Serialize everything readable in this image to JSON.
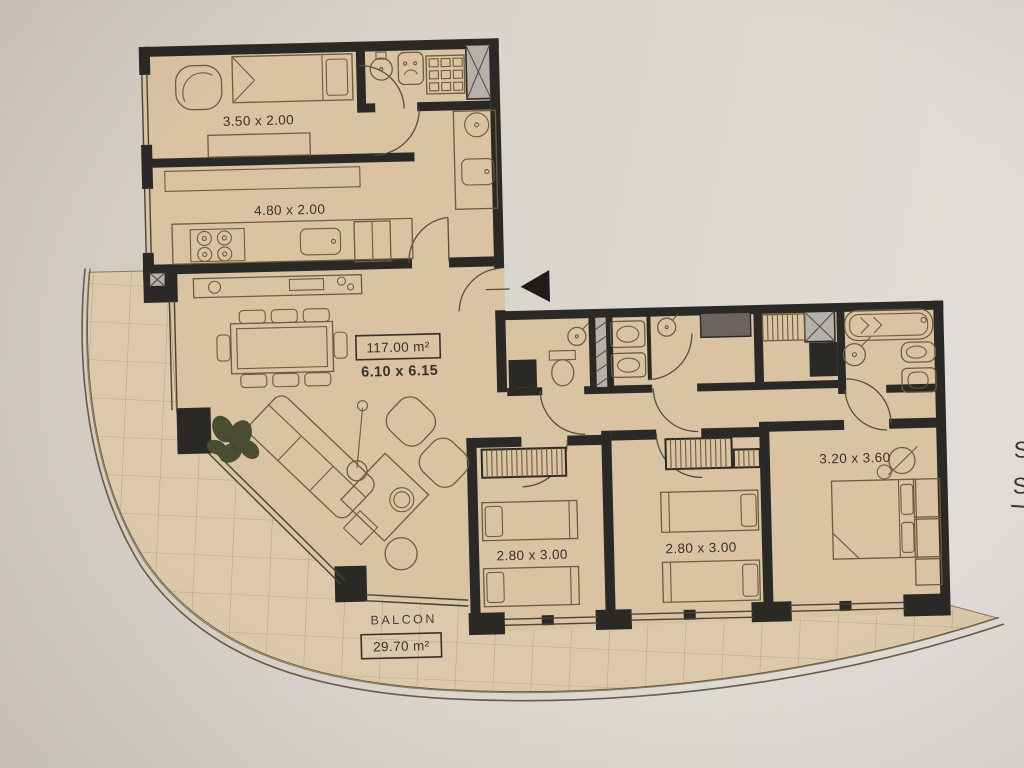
{
  "plan": {
    "labels": {
      "maid_room": "3.50 x 2.00",
      "kitchen": "4.80 x 2.00",
      "living_area": "117.00 m²",
      "living_dims": "6.10 x 6.15",
      "bedroom_a": "2.80 x 3.00",
      "bedroom_b": "2.80 x 3.00",
      "master_bedroom": "3.20 x 3.60",
      "balcony_name": "BALCON",
      "balcony_area": "29.70 m²",
      "edge_s1": "S",
      "edge_s2": "S"
    },
    "icons": {
      "entrance_arrow": "solid-left-triangle"
    },
    "colors": {
      "paper_left": "#d2ccc3",
      "paper_right": "#dfdcd7",
      "floor": "#d9c3a3",
      "balcony_floor": "#dcc9ab",
      "wall": "#2b2925",
      "furniture_line": "#6e5c3e",
      "tile_line": "#ac9671",
      "plant": "#4b4d33"
    }
  }
}
